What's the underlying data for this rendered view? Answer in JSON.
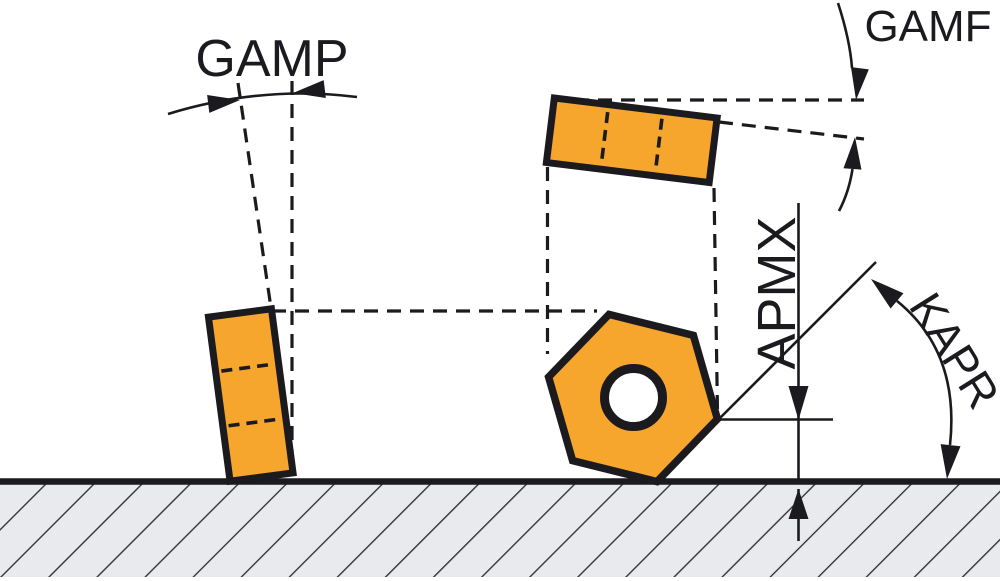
{
  "figure": {
    "type": "cutting-insert-geometry-diagram",
    "labels": {
      "gamp": "GAMP",
      "gamf": "GAMF",
      "apmx": "APMX",
      "kapr": "KAPR"
    },
    "colors": {
      "insert_orange": "#F6A52D",
      "line_black": "#1B1B1F",
      "workpiece_gray": "#E9EAED",
      "hatch_line": "#2F2F33",
      "background": "#FFFFFF"
    }
  }
}
